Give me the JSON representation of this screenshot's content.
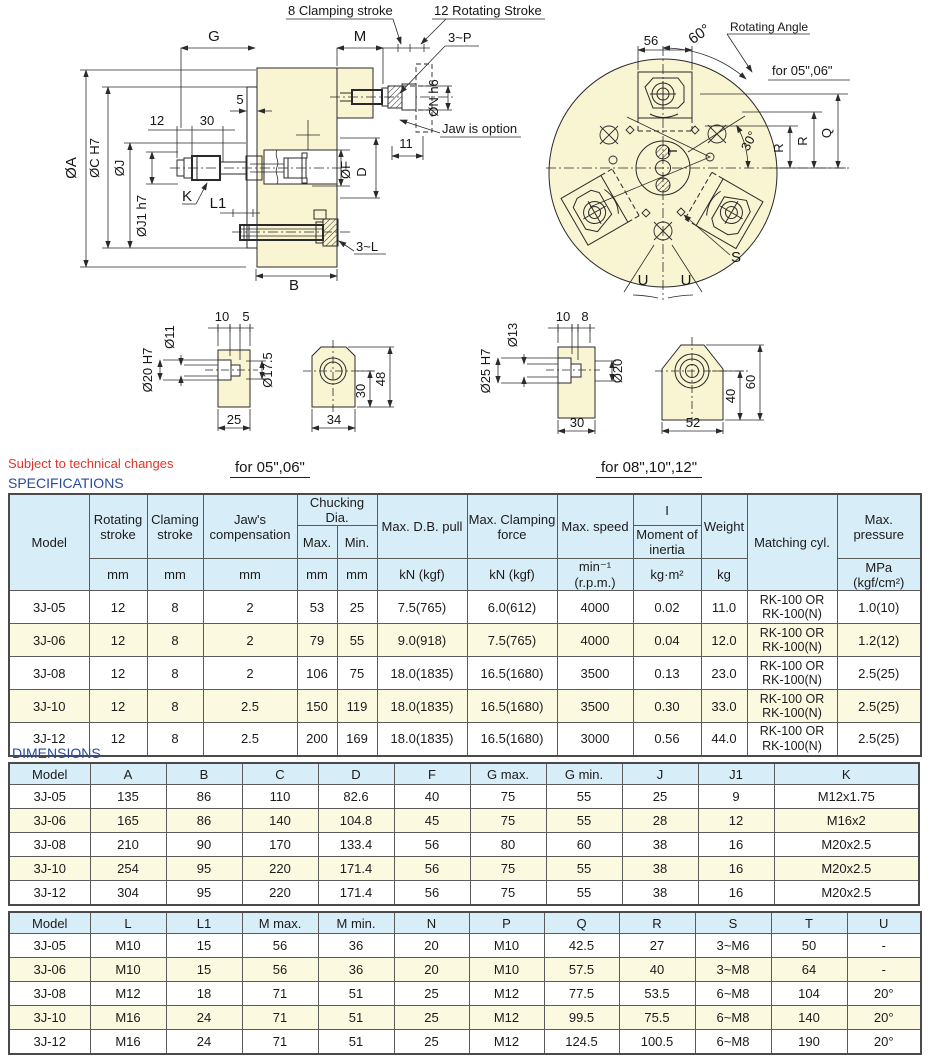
{
  "page": {
    "note": "Subject to technical changes",
    "specifications_title": "SPECIFICATIONS",
    "dimensions_title": "DIMENSIONS",
    "for_small_label": "for 05\",06\"",
    "for_large_label": "for 08\",10\",12\""
  },
  "drawing": {
    "side": {
      "clamping_stroke": "8 Clamping stroke",
      "rotating_stroke": "12 Rotating Stroke",
      "p3": "3~P",
      "g": "G",
      "m": "M",
      "n5": "5",
      "n12": "12",
      "n30": "30",
      "n11": "11",
      "oa": "ØA",
      "oc": "ØC H7",
      "oj": "ØJ",
      "oj1": "ØJ1 h7",
      "on": "ØN h6",
      "k": "K",
      "l1": "L1",
      "of": "ØF",
      "d": "D",
      "l3": "3~L",
      "b": "B",
      "jaw_option": "Jaw is option"
    },
    "front": {
      "n56": "56",
      "a60": "60°",
      "rotating_angle": "Rotating Angle",
      "for_small": "for 05\",06\"",
      "r": "R",
      "q": "Q",
      "a30": "30°",
      "s": "S",
      "u": "U",
      "t": "T"
    },
    "detail_a": {
      "n10": "10",
      "n5": "5",
      "o11": "Ø11",
      "o20": "Ø20 H7",
      "o175": "Ø17.5",
      "n25": "25"
    },
    "detail_b": {
      "n34": "34",
      "n30": "30",
      "n48": "48"
    },
    "detail_c": {
      "n10": "10",
      "n8": "8",
      "o13": "Ø13",
      "o25": "Ø25 H7",
      "o20": "Ø20",
      "n30": "30"
    },
    "detail_d": {
      "n52": "52",
      "n40": "40",
      "n60": "60"
    }
  },
  "spec_table": {
    "header": {
      "model": "Model",
      "rotating_stroke": "Rotating stroke",
      "clamping_stroke": "Claming stroke",
      "jaws_compensation": "Jaw's compensation",
      "chucking_dia": "Chucking Dia.",
      "max": "Max.",
      "min": "Min.",
      "db_pull": "Max. D.B. pull",
      "clamping_force": "Max. Clamping force",
      "max_speed": "Max. speed",
      "inertia_symbol": "I",
      "inertia": "Moment of inertia",
      "weight": "Weight",
      "matching_cyl": "Matching cyl.",
      "max_pressure": "Max. pressure"
    },
    "units": [
      "mm",
      "mm",
      "mm",
      "mm",
      "mm",
      "kN (kgf)",
      "kN (kgf)",
      "min⁻¹ (r.p.m.)",
      "kg·m²",
      "kg",
      "MPa (kgf/cm²)"
    ],
    "rows": [
      [
        "3J-05",
        "12",
        "8",
        "2",
        "53",
        "25",
        "7.5(765)",
        "6.0(612)",
        "4000",
        "0.02",
        "11.0",
        [
          "RK-100 OR",
          "RK-100(N)"
        ],
        "1.0(10)"
      ],
      [
        "3J-06",
        "12",
        "8",
        "2",
        "79",
        "55",
        "9.0(918)",
        "7.5(765)",
        "4000",
        "0.04",
        "12.0",
        [
          "RK-100 OR",
          "RK-100(N)"
        ],
        "1.2(12)"
      ],
      [
        "3J-08",
        "12",
        "8",
        "2",
        "106",
        "75",
        "18.0(1835)",
        "16.5(1680)",
        "3500",
        "0.13",
        "23.0",
        [
          "RK-100 OR",
          "RK-100(N)"
        ],
        "2.5(25)"
      ],
      [
        "3J-10",
        "12",
        "8",
        "2.5",
        "150",
        "119",
        "18.0(1835)",
        "16.5(1680)",
        "3500",
        "0.30",
        "33.0",
        [
          "RK-100 OR",
          "RK-100(N)"
        ],
        "2.5(25)"
      ],
      [
        "3J-12",
        "12",
        "8",
        "2.5",
        "200",
        "169",
        "18.0(1835)",
        "16.5(1680)",
        "3000",
        "0.56",
        "44.0",
        [
          "RK-100 OR",
          "RK-100(N)"
        ],
        "2.5(25)"
      ]
    ]
  },
  "dim_table_1": {
    "headers": [
      "Model",
      "A",
      "B",
      "C",
      "D",
      "F",
      "G max.",
      "G min.",
      "J",
      "J1",
      "K"
    ],
    "rows": [
      [
        "3J-05",
        "135",
        "86",
        "110",
        "82.6",
        "40",
        "75",
        "55",
        "25",
        "9",
        "M12x1.75"
      ],
      [
        "3J-06",
        "165",
        "86",
        "140",
        "104.8",
        "45",
        "75",
        "55",
        "28",
        "12",
        "M16x2"
      ],
      [
        "3J-08",
        "210",
        "90",
        "170",
        "133.4",
        "56",
        "80",
        "60",
        "38",
        "16",
        "M20x2.5"
      ],
      [
        "3J-10",
        "254",
        "95",
        "220",
        "171.4",
        "56",
        "75",
        "55",
        "38",
        "16",
        "M20x2.5"
      ],
      [
        "3J-12",
        "304",
        "95",
        "220",
        "171.4",
        "56",
        "75",
        "55",
        "38",
        "16",
        "M20x2.5"
      ]
    ]
  },
  "dim_table_2": {
    "headers": [
      "Model",
      "L",
      "L1",
      "M max.",
      "M min.",
      "N",
      "P",
      "Q",
      "R",
      "S",
      "T",
      "U"
    ],
    "rows": [
      [
        "3J-05",
        "M10",
        "15",
        "56",
        "36",
        "20",
        "M10",
        "42.5",
        "27",
        "3~M6",
        "50",
        "-"
      ],
      [
        "3J-06",
        "M10",
        "15",
        "56",
        "36",
        "20",
        "M10",
        "57.5",
        "40",
        "3~M8",
        "64",
        "-"
      ],
      [
        "3J-08",
        "M12",
        "18",
        "71",
        "51",
        "25",
        "M12",
        "77.5",
        "53.5",
        "6~M8",
        "104",
        "20°"
      ],
      [
        "3J-10",
        "M16",
        "24",
        "71",
        "51",
        "25",
        "M12",
        "99.5",
        "75.5",
        "6~M8",
        "140",
        "20°"
      ],
      [
        "3J-12",
        "M16",
        "24",
        "71",
        "51",
        "25",
        "M12",
        "124.5",
        "100.5",
        "6~M8",
        "190",
        "20°"
      ]
    ]
  }
}
